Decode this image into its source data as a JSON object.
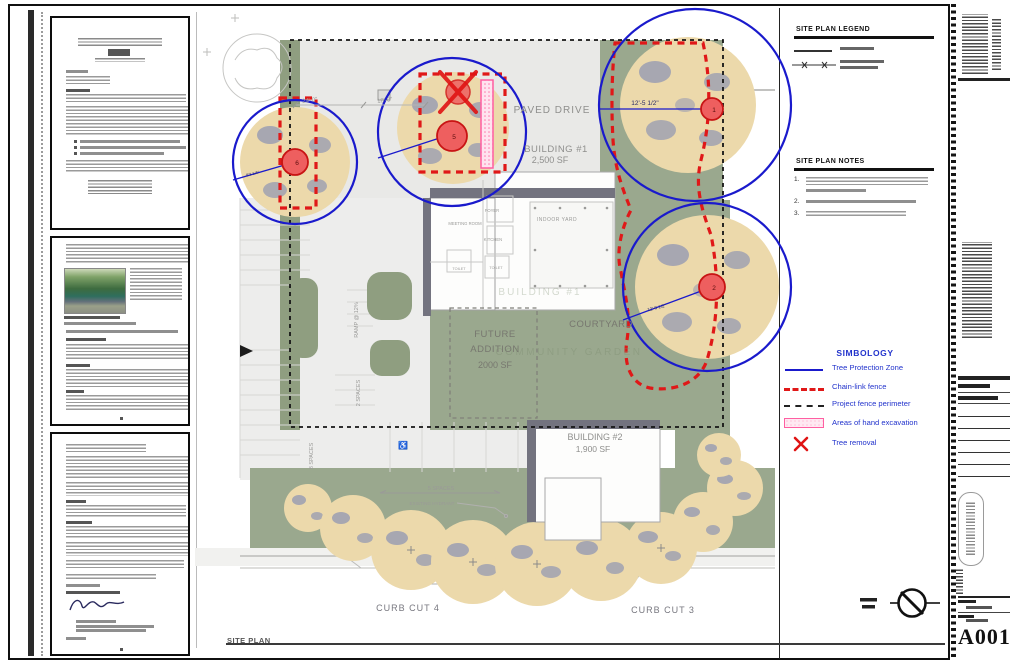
{
  "sheet": {
    "number": "A001",
    "drawing_title": "SITE PLAN"
  },
  "plan": {
    "labels": {
      "paved_drive": "PAVED DRIVE",
      "building1_name": "BUILDING #1",
      "building1_area": "2,500 SF",
      "building1_ghost": "BUILDING #1",
      "building2_name": "BUILDING #2",
      "building2_area": "1,900 SF",
      "future_l1": "FUTURE",
      "future_l2": "ADDITION",
      "future_l3": "2000 SF",
      "courtyard": "COURTYARD",
      "community_garden": "COMMUNITY GARDEN",
      "meeting_room": "MEETING ROOM",
      "foyer": "FOYER",
      "kitchen": "KITCHEN",
      "toilet_a": "TOILET",
      "toilet_b": "TOILET",
      "indoor_yard": "INDOOR YARD",
      "ramp": "RAMP @ 12%",
      "spaces_2": "2 SPACES",
      "spaces_8": "8 SPACES",
      "spaces_5": "5 SPACES",
      "existing_hydrant": "EXISTING HYDRANT",
      "curb_cut_4": "CURB CUT 4",
      "curb_cut_3": "CURB CUT 3"
    },
    "dimensions": {
      "drive_width": "24'-0\"",
      "drive_width2": "18'-0\"",
      "tree1_tpz_radius": "12'-5 1/2\"",
      "tree2_tpz_radius": "12'-8 1/2\"",
      "tree6_tpz_radius": "8'3 1/4\""
    },
    "tree_tags": {
      "tree1": "1",
      "tree2": "2",
      "tree5": "5",
      "tree6": "6"
    }
  },
  "legend_panel": {
    "legend_title": "SITE PLAN LEGEND",
    "notes_title": "SITE PLAN NOTES",
    "note_numbers": [
      "1.",
      "2.",
      "3."
    ]
  },
  "simbology": {
    "title": "SIMBOLOGY",
    "items": [
      {
        "id": "tree-protection-zone",
        "label": "Tree Protection Zone"
      },
      {
        "id": "chain-link-fence",
        "label": "Chain-link fence"
      },
      {
        "id": "project-fence-perimeter",
        "label": "Project fence perimeter"
      },
      {
        "id": "hand-excavation",
        "label": "Areas of hand excavation"
      },
      {
        "id": "tree-removal",
        "label": "Tree removal"
      }
    ]
  },
  "colors": {
    "tpz_blue": "#1a1acc",
    "fence_red": "#e01818",
    "excavation_pink": "#ff7bac",
    "landscape_green": "#9aa88e",
    "canopy_tan": "#ecd9ab"
  }
}
